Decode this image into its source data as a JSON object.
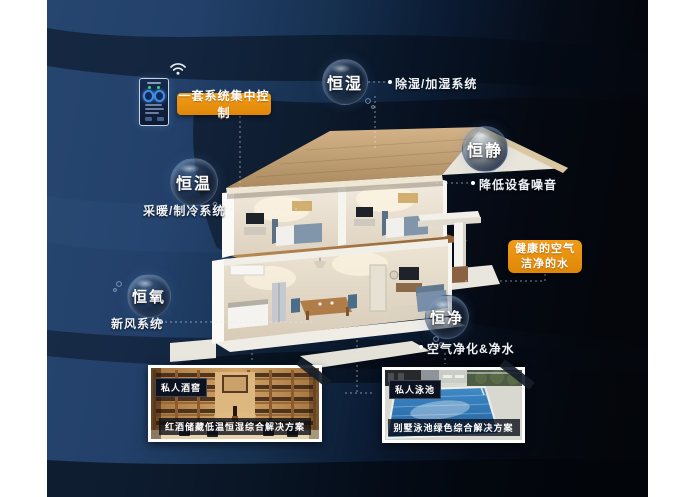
{
  "colors": {
    "accent_orange": "#e8910f",
    "bg_navy": "#23416a",
    "bg_dark": "#05080e",
    "bubble_rim": "#96b9dc"
  },
  "control_phone": {
    "tag": "一套系统集中控制"
  },
  "features": [
    {
      "name": "恒湿",
      "note": "除湿/加湿系统"
    },
    {
      "name": "恒静",
      "note": "降低设备噪音"
    },
    {
      "name": "恒温",
      "note": "采暖/制冷系统"
    },
    {
      "name": "恒氧",
      "note": "新风系统"
    },
    {
      "name": "恒净",
      "note": "空气净化&净水"
    }
  ],
  "highlight": {
    "line1": "健康的空气",
    "line2": "洁净的水"
  },
  "cards": [
    {
      "badge": "私人酒窖",
      "caption": "红酒储藏低温恒湿综合解决方案"
    },
    {
      "badge": "私人泳池",
      "caption": "别墅泳池绿色综合解决方案"
    }
  ]
}
